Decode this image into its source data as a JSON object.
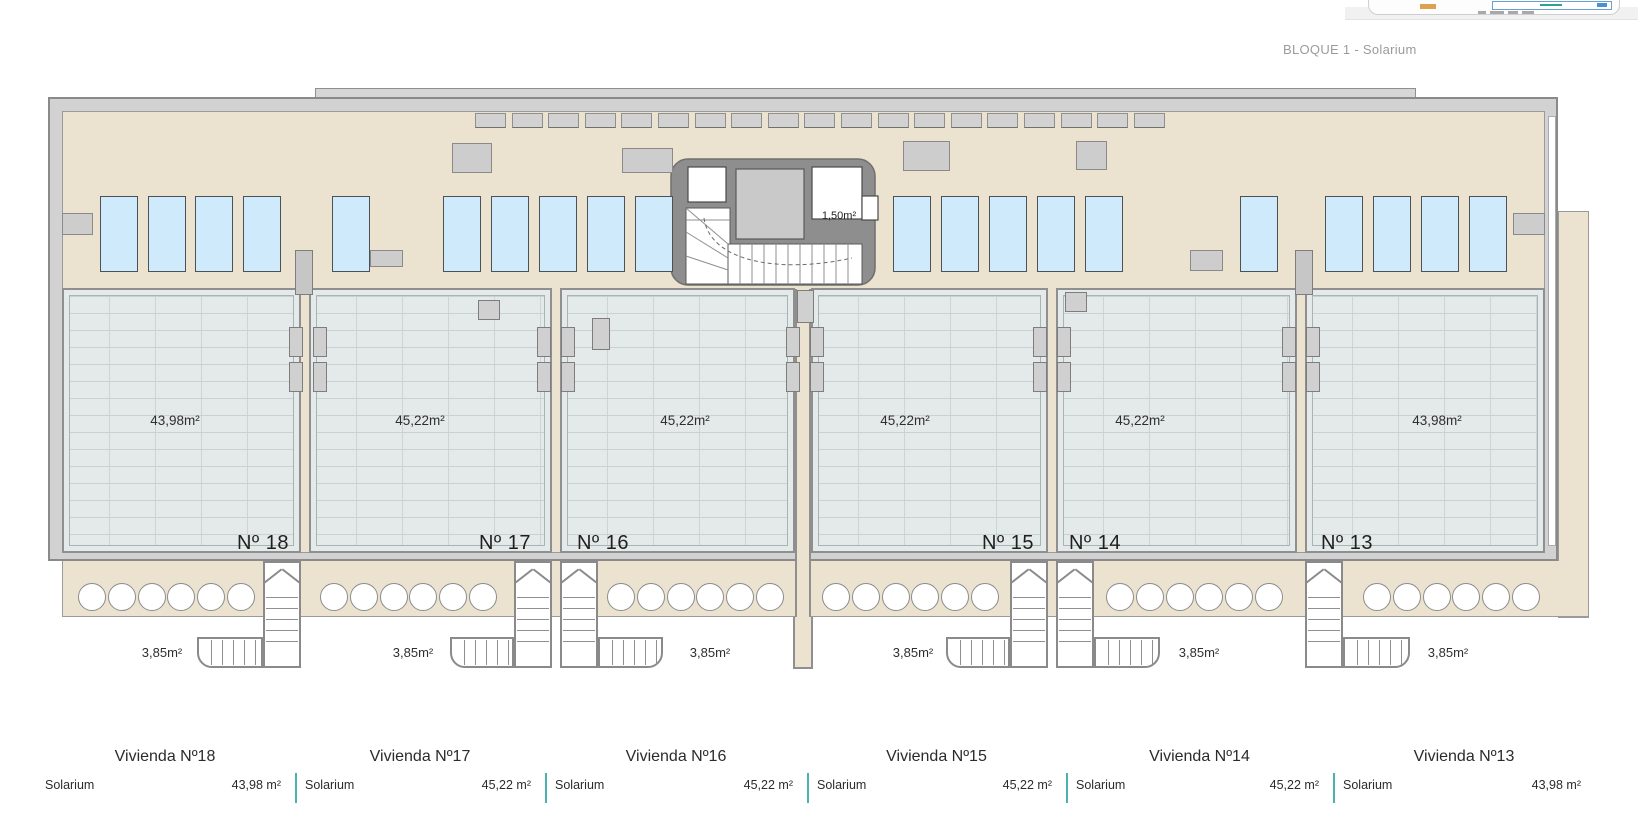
{
  "header": {
    "title": "BLOQUE 1 - Solarium"
  },
  "plan": {
    "core_label": "1,50m²",
    "stair_area_label": "3,85m²",
    "units": [
      {
        "number": "Nº 18",
        "area": "43,98m²"
      },
      {
        "number": "Nº 17",
        "area": "45,22m²"
      },
      {
        "number": "Nº 16",
        "area": "45,22m²"
      },
      {
        "number": "Nº 15",
        "area": "45,22m²"
      },
      {
        "number": "Nº 14",
        "area": "45,22m²"
      },
      {
        "number": "Nº 13",
        "area": "43,98m²"
      }
    ]
  },
  "legend_table": {
    "columns": [
      {
        "title": "Vivienda Nº18",
        "room": "Solarium",
        "area": "43,98 m²"
      },
      {
        "title": "Vivienda Nº17",
        "room": "Solarium",
        "area": "45,22 m²"
      },
      {
        "title": "Vivienda Nº16",
        "room": "Solarium",
        "area": "45,22 m²"
      },
      {
        "title": "Vivienda Nº15",
        "room": "Solarium",
        "area": "45,22 m²"
      },
      {
        "title": "Vivienda Nº14",
        "room": "Solarium",
        "area": "45,22 m²"
      },
      {
        "title": "Vivienda Nº13",
        "room": "Solarium",
        "area": "43,98 m²"
      }
    ],
    "divider_color": "#49b3b1"
  },
  "colors": {
    "terrace_beige": "#ebe3d0",
    "tile_gray": "#e4eae9",
    "wall_gray": "#8f8f8f",
    "sunbed_blue": "#cfeafa",
    "accent_teal": "#49b3b1",
    "title_gray": "#9b9b9b"
  }
}
